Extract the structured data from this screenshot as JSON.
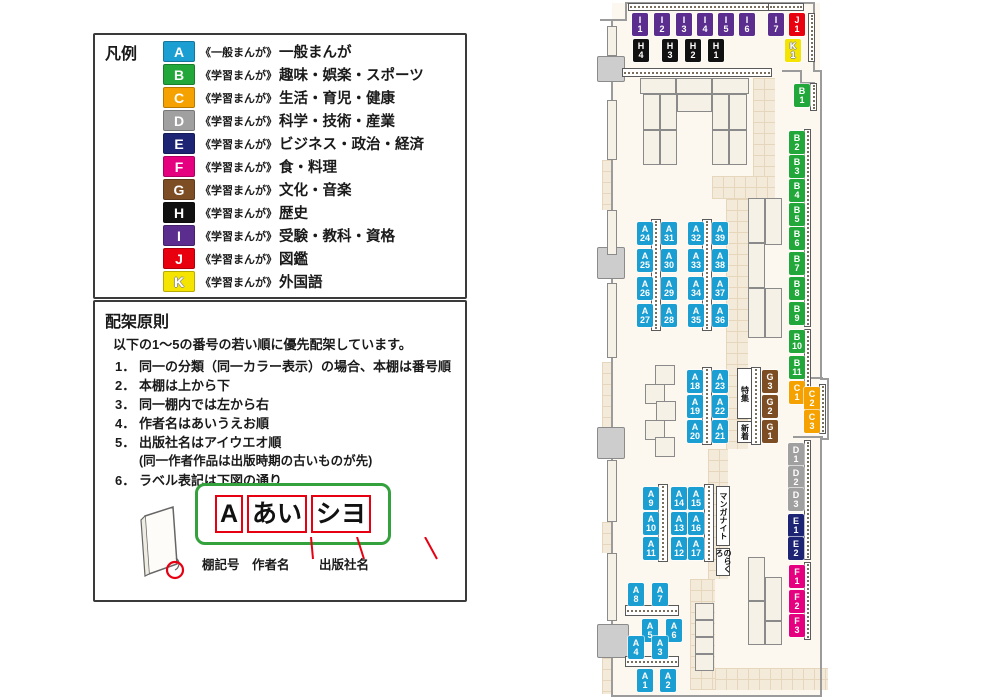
{
  "legend": {
    "title": "凡例",
    "items": [
      {
        "code": "A",
        "color": "#1b9ed2",
        "scope": "《一般まんが》",
        "label": "一般まんが"
      },
      {
        "code": "B",
        "color": "#22a73b",
        "scope": "《学習まんが》",
        "label": "趣味・娯楽・スポーツ"
      },
      {
        "code": "C",
        "color": "#f5a100",
        "scope": "《学習まんが》",
        "label": "生活・育児・健康"
      },
      {
        "code": "D",
        "color": "#a0a0a0",
        "scope": "《学習まんが》",
        "label": "科学・技術・産業"
      },
      {
        "code": "E",
        "color": "#1d2474",
        "scope": "《学習まんが》",
        "label": "ビジネス・政治・経済"
      },
      {
        "code": "F",
        "color": "#e4007f",
        "scope": "《学習まんが》",
        "label": "食・料理"
      },
      {
        "code": "G",
        "color": "#7d4e24",
        "scope": "《学習まんが》",
        "label": "文化・音楽"
      },
      {
        "code": "H",
        "color": "#111111",
        "scope": "《学習まんが》",
        "label": "歴史"
      },
      {
        "code": "I",
        "color": "#5b2d8e",
        "scope": "《学習まんが》",
        "label": "受験・教科・資格"
      },
      {
        "code": "J",
        "color": "#e8000f",
        "scope": "《学習まんが》",
        "label": "図鑑"
      },
      {
        "code": "K",
        "color": "#f5e300",
        "scope": "《学習まんが》",
        "label": "外国語",
        "outline": true
      }
    ]
  },
  "principles": {
    "title": "配架原則",
    "intro": "以下の1〜5の番号の若い順に優先配架しています。",
    "rules": [
      {
        "num": "1．",
        "text": "同一の分類（同一カラー表示）の場合、本棚は番号順"
      },
      {
        "num": "2．",
        "text": "本棚は上から下"
      },
      {
        "num": "3．",
        "text": "同一棚内では左から右"
      },
      {
        "num": "4．",
        "text": "作者名はあいうえお順"
      },
      {
        "num": "5．",
        "text": "出版社名はアイウエオ順",
        "sub": "(同一作者作品は出版時期の古いものが先)"
      },
      {
        "num": "6．",
        "text": "ラベル表記は下図の通り"
      }
    ],
    "label_example": {
      "segments": [
        "A",
        "あい",
        "シヨ"
      ],
      "captions": [
        "棚記号",
        "作者名",
        "出版社名"
      ]
    }
  },
  "map": {
    "category_colors": {
      "A": "#1b9ed2",
      "B": "#22a73b",
      "C": "#f5a100",
      "D": "#a0a0a0",
      "E": "#1d2474",
      "F": "#e4007f",
      "G": "#7d4e24",
      "H": "#111111",
      "I": "#5b2d8e",
      "J": "#e8000f",
      "K": "#f5e300"
    },
    "shelf_labels": [
      {
        "id": "I1",
        "x": 632,
        "y": 13
      },
      {
        "id": "I2",
        "x": 654,
        "y": 13
      },
      {
        "id": "I3",
        "x": 676,
        "y": 13
      },
      {
        "id": "I4",
        "x": 697,
        "y": 13
      },
      {
        "id": "I5",
        "x": 718,
        "y": 13
      },
      {
        "id": "I6",
        "x": 739,
        "y": 13
      },
      {
        "id": "I7",
        "x": 768,
        "y": 13
      },
      {
        "id": "J1",
        "x": 789,
        "y": 13
      },
      {
        "id": "K1",
        "x": 785,
        "y": 39
      },
      {
        "id": "H4",
        "x": 633,
        "y": 39
      },
      {
        "id": "H3",
        "x": 662,
        "y": 39
      },
      {
        "id": "H2",
        "x": 685,
        "y": 39
      },
      {
        "id": "H1",
        "x": 708,
        "y": 39
      },
      {
        "id": "B1",
        "x": 794,
        "y": 84
      },
      {
        "id": "B2",
        "x": 789,
        "y": 131
      },
      {
        "id": "B3",
        "x": 789,
        "y": 155
      },
      {
        "id": "B4",
        "x": 789,
        "y": 179
      },
      {
        "id": "B5",
        "x": 789,
        "y": 203
      },
      {
        "id": "B6",
        "x": 789,
        "y": 227
      },
      {
        "id": "B7",
        "x": 789,
        "y": 252
      },
      {
        "id": "B8",
        "x": 789,
        "y": 277
      },
      {
        "id": "B9",
        "x": 789,
        "y": 302
      },
      {
        "id": "B10",
        "x": 789,
        "y": 330
      },
      {
        "id": "B11",
        "x": 789,
        "y": 356
      },
      {
        "id": "C1",
        "x": 789,
        "y": 381
      },
      {
        "id": "C2",
        "x": 804,
        "y": 387
      },
      {
        "id": "C3",
        "x": 804,
        "y": 410
      },
      {
        "id": "D1",
        "x": 788,
        "y": 443
      },
      {
        "id": "D2",
        "x": 788,
        "y": 466
      },
      {
        "id": "D3",
        "x": 788,
        "y": 488
      },
      {
        "id": "E1",
        "x": 788,
        "y": 514
      },
      {
        "id": "E2",
        "x": 788,
        "y": 537
      },
      {
        "id": "F1",
        "x": 789,
        "y": 565
      },
      {
        "id": "F2",
        "x": 789,
        "y": 590
      },
      {
        "id": "F3",
        "x": 789,
        "y": 614
      },
      {
        "id": "G3",
        "x": 762,
        "y": 370
      },
      {
        "id": "G2",
        "x": 762,
        "y": 395
      },
      {
        "id": "G1",
        "x": 762,
        "y": 420
      },
      {
        "id": "A24",
        "x": 637,
        "y": 222
      },
      {
        "id": "A25",
        "x": 637,
        "y": 249
      },
      {
        "id": "A26",
        "x": 637,
        "y": 277
      },
      {
        "id": "A27",
        "x": 637,
        "y": 304
      },
      {
        "id": "A31",
        "x": 661,
        "y": 222
      },
      {
        "id": "A30",
        "x": 661,
        "y": 249
      },
      {
        "id": "A29",
        "x": 661,
        "y": 277
      },
      {
        "id": "A28",
        "x": 661,
        "y": 304
      },
      {
        "id": "A32",
        "x": 688,
        "y": 222
      },
      {
        "id": "A33",
        "x": 688,
        "y": 249
      },
      {
        "id": "A34",
        "x": 688,
        "y": 277
      },
      {
        "id": "A35",
        "x": 688,
        "y": 304
      },
      {
        "id": "A39",
        "x": 712,
        "y": 222
      },
      {
        "id": "A38",
        "x": 712,
        "y": 249
      },
      {
        "id": "A37",
        "x": 712,
        "y": 277
      },
      {
        "id": "A36",
        "x": 712,
        "y": 304
      },
      {
        "id": "A18",
        "x": 687,
        "y": 370
      },
      {
        "id": "A19",
        "x": 687,
        "y": 395
      },
      {
        "id": "A20",
        "x": 687,
        "y": 420
      },
      {
        "id": "A23",
        "x": 712,
        "y": 370
      },
      {
        "id": "A22",
        "x": 712,
        "y": 395
      },
      {
        "id": "A21",
        "x": 712,
        "y": 420
      },
      {
        "id": "A9",
        "x": 643,
        "y": 487
      },
      {
        "id": "A10",
        "x": 643,
        "y": 512
      },
      {
        "id": "A11",
        "x": 643,
        "y": 537
      },
      {
        "id": "A14",
        "x": 671,
        "y": 487
      },
      {
        "id": "A13",
        "x": 671,
        "y": 512
      },
      {
        "id": "A12",
        "x": 671,
        "y": 537
      },
      {
        "id": "A15",
        "x": 688,
        "y": 487
      },
      {
        "id": "A16",
        "x": 688,
        "y": 512
      },
      {
        "id": "A17",
        "x": 688,
        "y": 537
      },
      {
        "id": "A8",
        "x": 628,
        "y": 583
      },
      {
        "id": "A7",
        "x": 652,
        "y": 583
      },
      {
        "id": "A5",
        "x": 642,
        "y": 619
      },
      {
        "id": "A6",
        "x": 666,
        "y": 619
      },
      {
        "id": "A4",
        "x": 628,
        "y": 636
      },
      {
        "id": "A3",
        "x": 652,
        "y": 636
      },
      {
        "id": "A1",
        "x": 637,
        "y": 669
      },
      {
        "id": "A2",
        "x": 660,
        "y": 669
      }
    ],
    "area_labels": [
      {
        "text": "特集",
        "x": 737,
        "y": 368,
        "w": 15,
        "h": 51
      },
      {
        "text": "新着",
        "x": 737,
        "y": 421,
        "w": 15,
        "h": 22
      },
      {
        "text": "マンガナイト",
        "x": 716,
        "y": 486,
        "w": 14,
        "h": 60
      },
      {
        "text": "のらくろ",
        "x": 716,
        "y": 548,
        "w": 14,
        "h": 28
      }
    ]
  }
}
